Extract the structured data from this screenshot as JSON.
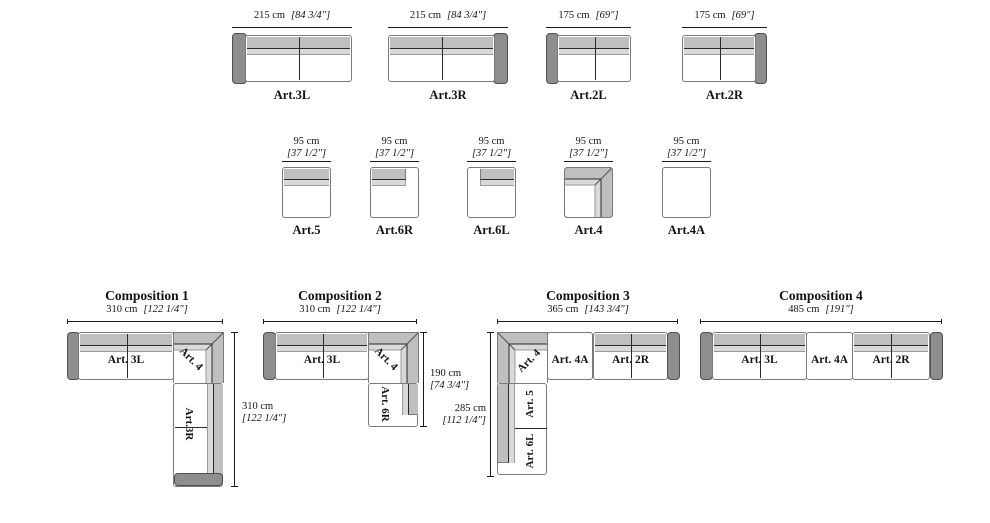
{
  "row1": {
    "items": [
      {
        "label": "Art.3L",
        "dim_cm": "215 cm",
        "dim_in": "[84 3/4\"]",
        "armrest": "left"
      },
      {
        "label": "Art.3R",
        "dim_cm": "215 cm",
        "dim_in": "[84 3/4\"]",
        "armrest": "right"
      },
      {
        "label": "Art.2L",
        "dim_cm": "175 cm",
        "dim_in": "[69\"]",
        "armrest": "left"
      },
      {
        "label": "Art.2R",
        "dim_cm": "175 cm",
        "dim_in": "[69\"]",
        "armrest": "right"
      }
    ]
  },
  "row2": {
    "items": [
      {
        "label": "Art.5",
        "dim_cm": "95 cm",
        "dim_in": "[37 1/2\"]",
        "backrest": "full"
      },
      {
        "label": "Art.6R",
        "dim_cm": "95 cm",
        "dim_in": "[37 1/2\"]",
        "backrest": "left-partial"
      },
      {
        "label": "Art.6L",
        "dim_cm": "95 cm",
        "dim_in": "[37 1/2\"]",
        "backrest": "right-partial"
      },
      {
        "label": "Art.4",
        "dim_cm": "95 cm",
        "dim_in": "[37 1/2\"]",
        "backrest": "corner"
      },
      {
        "label": "Art.4A",
        "dim_cm": "95 cm",
        "dim_in": "[37 1/2\"]",
        "backrest": "none"
      }
    ]
  },
  "compositions": [
    {
      "title": "Composition 1",
      "dim_w_cm": "310 cm",
      "dim_w_in": "[122 1/4\"]",
      "dim_h_cm": "310 cm",
      "dim_h_in": "[122 1/4\"]",
      "labels": {
        "seat": "Art. 3L",
        "corner": "Art. 4",
        "vertical": "Art.3R"
      }
    },
    {
      "title": "Composition 2",
      "dim_w_cm": "310 cm",
      "dim_w_in": "[122 1/4\"]",
      "dim_h_cm": "190 cm",
      "dim_h_in": "[74 3/4\"]",
      "labels": {
        "seat": "Art. 3L",
        "corner": "Art. 4",
        "vertical": "Art. 6R"
      }
    },
    {
      "title": "Composition 3",
      "dim_w_cm": "365 cm",
      "dim_w_in": "[143 3/4\"]",
      "dim_h_cm": "285 cm",
      "dim_h_in": "[112 1/4\"]",
      "labels": {
        "corner": "Art. 4",
        "seat1": "Art. 4A",
        "seat2": "Art. 2R",
        "vertical1": "Art. 5",
        "vertical2": "Art. 6L"
      }
    },
    {
      "title": "Composition 4",
      "dim_w_cm": "485 cm",
      "dim_w_in": "[191\"]",
      "labels": {
        "seat1": "Art. 3L",
        "seat2": "Art. 4A",
        "seat3": "Art. 2R"
      }
    }
  ],
  "colors": {
    "armrest": "#8e8e8e",
    "backrest_outer": "#bfbfbf",
    "backrest_inner": "#d9d9d9",
    "outline": "#7a7a7a",
    "line": "#1a1a1a"
  }
}
